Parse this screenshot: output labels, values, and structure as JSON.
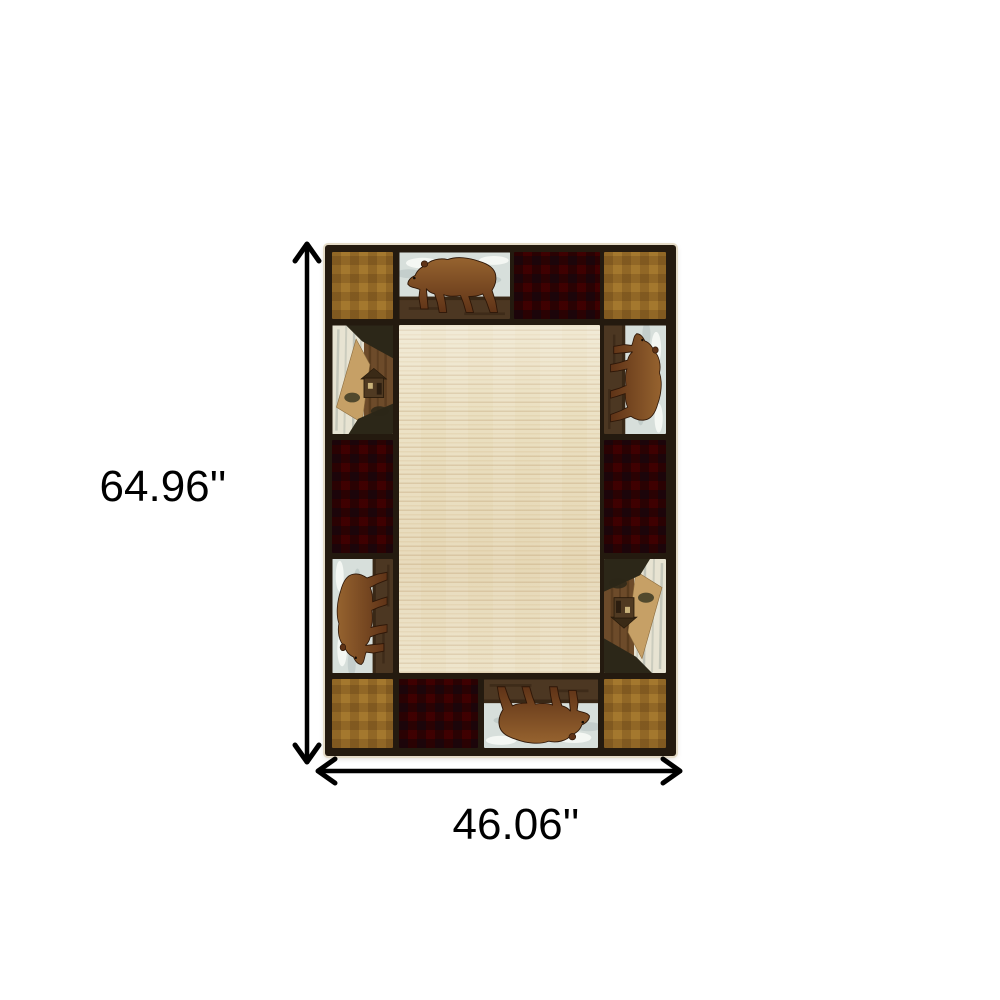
{
  "figure": {
    "type": "product-dimension-image",
    "subject": "Lodge-style patchwork area rug with bears, buffalo plaid and gingham border",
    "height_label": "64.96''",
    "width_label": "46.06''",
    "colors": {
      "background": "#ffffff",
      "text": "#000000",
      "arrow": "#000000",
      "rug_border": "#241a0f",
      "gingham_light": "#dcc690",
      "gingham_stripe": "#c3ab78",
      "plaid_red": "#a02028",
      "plaid_stripe": "#6a6a7e",
      "field_cream": "#eadfc0",
      "bear_brown": "#5f3317",
      "bear_highlight": "#96632f",
      "sky_light": "#d7dfdb",
      "sky_shadow": "#aebbba",
      "ground_brown": "#4c3722",
      "scene_birch": "#e7e3d2",
      "scene_wood": "#6d4b2a",
      "scene_tan": "#c6a066",
      "scene_dark": "#2c2718"
    },
    "rug": {
      "panels": [
        "gingham-top-left",
        "bear-top",
        "plaid-top",
        "gingham-top-right",
        "scene-left",
        "plaid-left",
        "bear-left",
        "gingham-bottom-left",
        "bear-right",
        "plaid-right",
        "scene-right",
        "gingham-bottom-right",
        "plaid-bottom",
        "bear-bottom",
        "center-field"
      ]
    }
  }
}
